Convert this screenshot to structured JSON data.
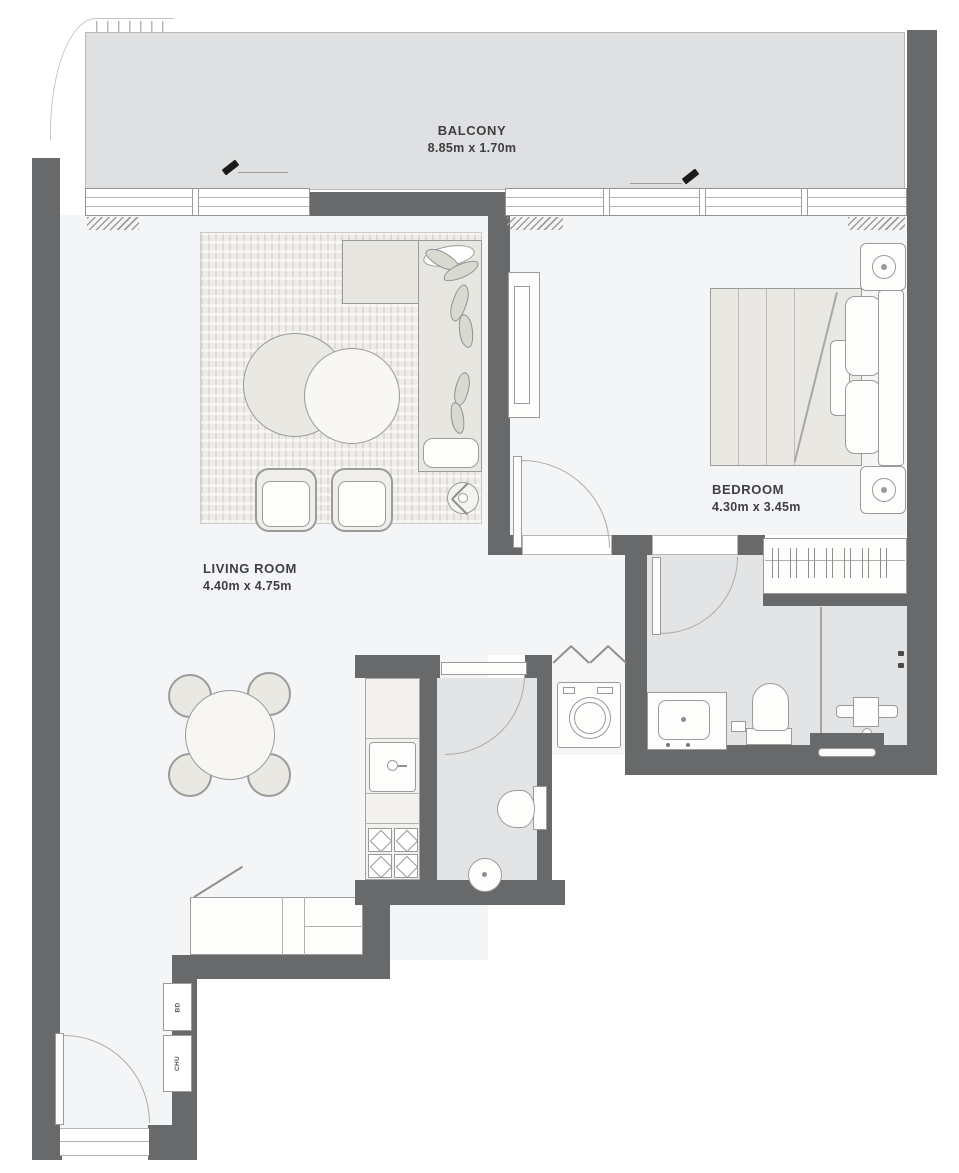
{
  "rooms": {
    "balcony": {
      "name": "BALCONY",
      "dims": "8.85m x 1.70m"
    },
    "living": {
      "name": "LIVING ROOM",
      "dims": "4.40m x 4.75m"
    },
    "bedroom": {
      "name": "BEDROOM",
      "dims": "4.30m x 3.45m"
    }
  },
  "shafts": {
    "top": "BD",
    "bottom": "CHU"
  },
  "colors": {
    "wall": "#68696b",
    "balcony_floor": "#dfe0e1",
    "room_floor": "#f4f5f7",
    "bath_floor": "#e3e4e6",
    "furniture": "#e9e8e2",
    "label": "#3e3f41"
  }
}
